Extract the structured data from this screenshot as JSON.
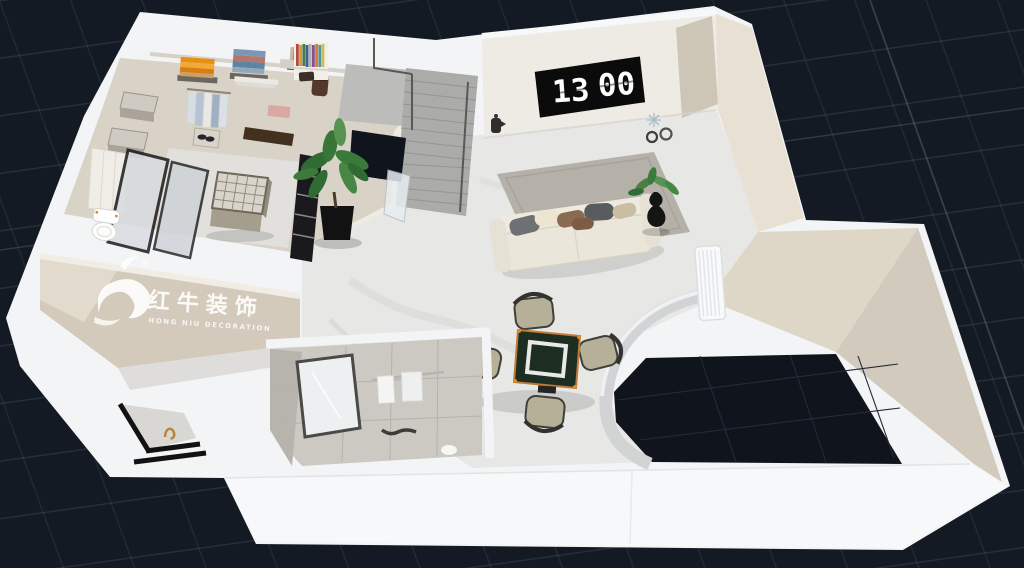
{
  "scene": {
    "type": "3d-floorplan-isometric-render",
    "canvas_width": 1024,
    "canvas_height": 568,
    "view": "overhead dollhouse view on dark perspective grid"
  },
  "colors": {
    "background": "#141a23",
    "grid_line": "#3a4656",
    "outer_wall": "#f3f4f6",
    "bottom_wall_face": "#f7f8fa",
    "wall_face_beige": "#ded6c6",
    "wall_face_beige_dark": "#d2cabc",
    "wall_face_inner": "#e8e1d3",
    "watermark_wall": "#d3cabb",
    "closet_floor": "#d9d2c6",
    "marble_floor": "#e7e7e5",
    "bathroom_tile": "#ccc9c3",
    "stairs": "#ababa9",
    "void": "#10151d",
    "curved_wall": "#d2d3d5",
    "rug": "#b5b0a8",
    "sofa": "#ebe6da",
    "plant_green": "#3a7a3a",
    "mahjong_table_top": "#1b2e21",
    "mahjong_table_trim": "#c07a35",
    "chair_fabric": "#b7b099",
    "clock_screen": "#0b0b0b",
    "clock_digits": "#ffffff",
    "watermark_text": "#ffffff",
    "gold_faucet": "#b8863b"
  },
  "tv_wall": {
    "device": "flip-clock-display",
    "clock_hours": "13",
    "clock_minutes": "00"
  },
  "watermark": {
    "icon": "bull-logo-icon",
    "registered_mark": "®",
    "name_cn": "红牛装饰",
    "name_en": "HONG NIU DECORATION"
  },
  "rooms": [
    {
      "name": "walk-in-closet",
      "contents": [
        "folded clothes stacks (orange, blue, multicolor)",
        "hanging clothes",
        "marble storage boxes",
        "shoe box",
        "island dresser with grid top",
        "glass wardrobe doors",
        "dark sideboard",
        "pink folded item",
        "brown bag"
      ]
    },
    {
      "name": "toilet-room",
      "contents": [
        "toilet"
      ]
    },
    {
      "name": "hallway",
      "contents": [
        "staircase",
        "stair landing",
        "stairwell opening",
        "glass balustrade",
        "large potted plant",
        "book shelf",
        "dark slatted cabinet"
      ]
    },
    {
      "name": "living-room",
      "contents": [
        "tv wall with flip clock",
        "kettle",
        "star ornament",
        "two rings",
        "gray area rug",
        "cream three-seat sofa",
        "throw pillows",
        "black vase with plant",
        "white radiator",
        "curved partition wall"
      ]
    },
    {
      "name": "mahjong-corner",
      "contents": [
        "green mahjong table with white border",
        "four fabric armchairs"
      ]
    },
    {
      "name": "bathroom",
      "contents": [
        "gray wall tiles",
        "framed mirror",
        "towel rail with two towels",
        "black wall hooks",
        "paper roll"
      ]
    },
    {
      "name": "vanity-nook",
      "contents": [
        "marble counter",
        "gold faucet",
        "black trim ledges"
      ]
    }
  ]
}
